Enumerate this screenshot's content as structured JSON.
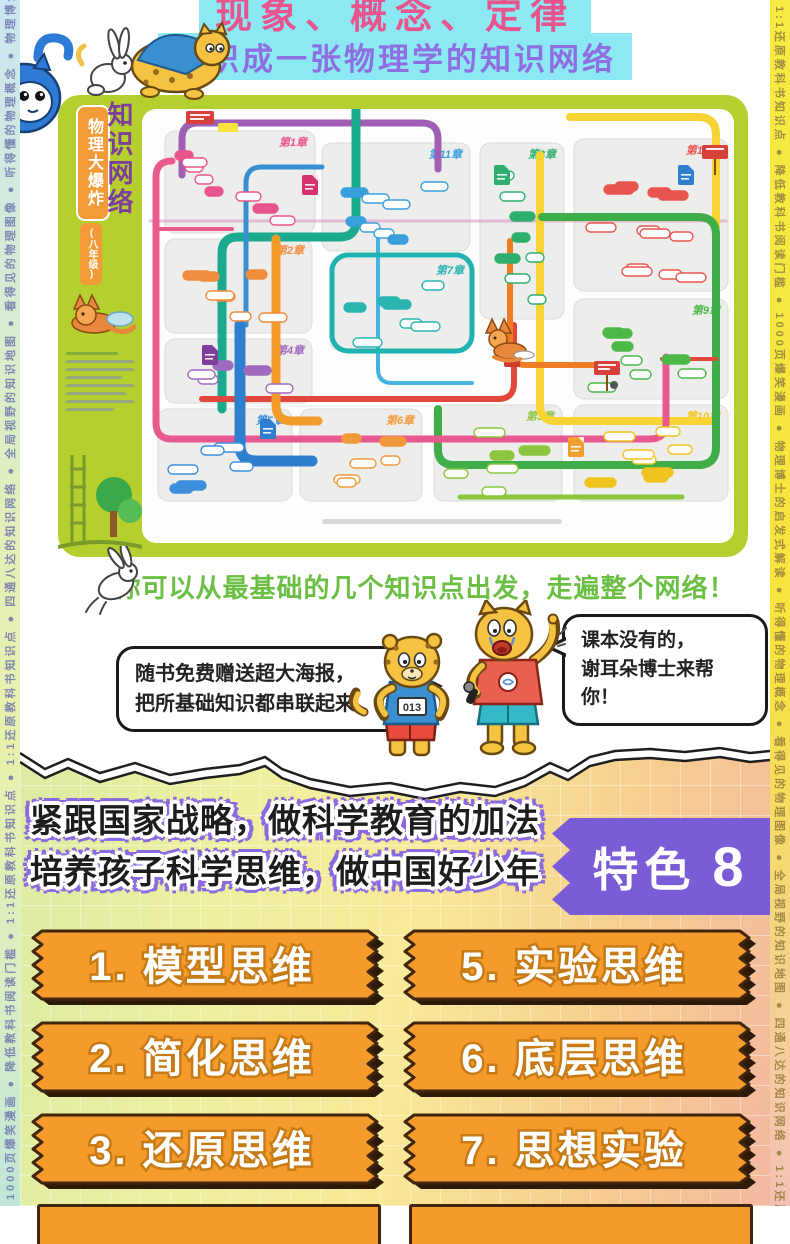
{
  "rails": {
    "left_text": "1000页爆笑漫画 ● 降低教科书阅读门槛 ● 1:1还原教科书知识点 ● 1:1还原教科书知识点 ● 四通八达的知识网络 ● 全局视野的知识地图 ● 看得见的物理图像 ● 听得懂的物理概念 ● 物理博士的启发式解读",
    "right_text": "1:1还原教科书知识点 ● 降低教科书阅读门槛 ● 1000页爆笑漫画 ● 物理博士的启发式解读 ● 听得懂的物理概念 ● 看得见的物理图像 ● 全局视野的知识地图 ● 四通八达的知识网络 ● 1:1还原教科书知识点"
  },
  "header": {
    "line1": "现象、概念、定律",
    "line2": "编织成一张物理学的知识网络",
    "highlight_color": "#8ce9f4",
    "line1_color": "#e7548e",
    "line2_color": "#8d6fe2"
  },
  "poster": {
    "title_vertical": "知识网络",
    "series": "物理大爆炸",
    "grade": "(八年级)",
    "bg_color": "#b5cf2f",
    "chapters": [
      {
        "label": "第1章",
        "color": "#e8548c"
      },
      {
        "label": "第2章",
        "color": "#f08c3c"
      },
      {
        "label": "第3章",
        "color": "#8cc63f"
      },
      {
        "label": "第4章",
        "color": "#a06bbf"
      },
      {
        "label": "第5章",
        "color": "#3e8ede"
      },
      {
        "label": "第6章",
        "color": "#f09a3c"
      },
      {
        "label": "第7章",
        "color": "#2bb5b0"
      },
      {
        "label": "第8章",
        "color": "#2eaf6e"
      },
      {
        "label": "第9章",
        "color": "#4cb848"
      },
      {
        "label": "第10章",
        "color": "#f0c41f"
      },
      {
        "label": "第11章",
        "color": "#3aa0dc"
      },
      {
        "label": "第12章",
        "color": "#e8554f"
      }
    ]
  },
  "tagline": {
    "text": "你可以从最基础的几个知识点出发，走遍整个网络！",
    "color": "#6cbf45"
  },
  "mascots": {
    "left_bubble_line1": "随书免费赠送超大海报，",
    "left_bubble_line2": "把所基础知识都串联起来。",
    "right_bubble_line1": "课本没有的，",
    "right_bubble_line2": "谢耳朵博士来帮你！",
    "leopard_bib_number": "013"
  },
  "feature": {
    "heading_line1": "紧跟国家战略，做科学教育的加法",
    "heading_line2": "培养孩子科学思维，做中国好少年",
    "badge_label": "特色",
    "badge_number": "8",
    "badge_color": "#7a5cd6",
    "item_color": "#f59b2b",
    "items": [
      {
        "label": "1. 模型思维"
      },
      {
        "label": "5. 实验思维"
      },
      {
        "label": "2. 简化思维"
      },
      {
        "label": "6. 底层思维"
      },
      {
        "label": "3. 还原思维"
      },
      {
        "label": "7. 思想实验"
      }
    ]
  }
}
